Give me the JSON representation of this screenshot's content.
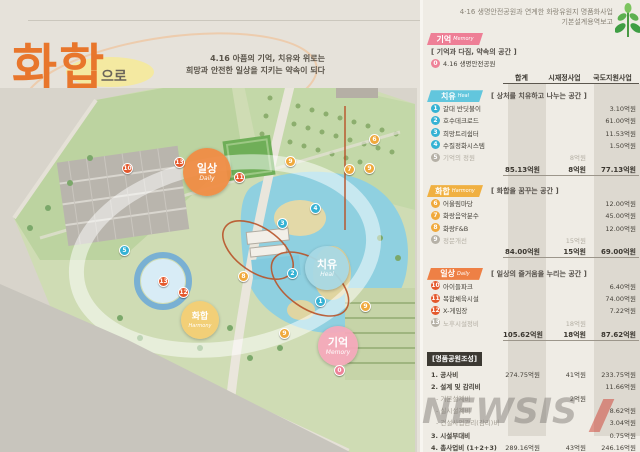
{
  "header": {
    "line1": "4·16 생명안전공원과 연계한 화랑유원지 명품화사업",
    "line2": "기본설계용역보고"
  },
  "title": {
    "word1": "화합",
    "particle": "으로",
    "word2": "순환",
    "suffix": "하다",
    "subtitle1": "4.16 아픔의 기억, 치유와 위로는",
    "subtitle2": "희망과 안전한 일상을 지키는 약속이 되다"
  },
  "map": {
    "zones": [
      {
        "name": "일상",
        "en": "Daily"
      },
      {
        "name": "치유",
        "en": "Heal"
      },
      {
        "name": "화합",
        "en": "Harmony"
      },
      {
        "name": "기억",
        "en": "Memory"
      }
    ],
    "markers": [
      {
        "n": "10",
        "x": 127,
        "y": 168,
        "k": "daily"
      },
      {
        "n": "13",
        "x": 179,
        "y": 162,
        "k": "daily"
      },
      {
        "n": "11",
        "x": 239,
        "y": 177,
        "k": "daily"
      },
      {
        "n": "9",
        "x": 290,
        "y": 161,
        "k": "harmony"
      },
      {
        "n": "6",
        "x": 374,
        "y": 139,
        "k": "harmony"
      },
      {
        "n": "7",
        "x": 349,
        "y": 169,
        "k": "harmony"
      },
      {
        "n": "9",
        "x": 369,
        "y": 168,
        "k": "harmony"
      },
      {
        "n": "4",
        "x": 315,
        "y": 208,
        "k": "heal"
      },
      {
        "n": "3",
        "x": 282,
        "y": 223,
        "k": "heal"
      },
      {
        "n": "5",
        "x": 124,
        "y": 250,
        "k": "heal"
      },
      {
        "n": "2",
        "x": 292,
        "y": 273,
        "k": "heal"
      },
      {
        "n": "1",
        "x": 320,
        "y": 301,
        "k": "heal"
      },
      {
        "n": "8",
        "x": 243,
        "y": 276,
        "k": "harmony"
      },
      {
        "n": "9",
        "x": 365,
        "y": 306,
        "k": "harmony"
      },
      {
        "n": "9",
        "x": 284,
        "y": 333,
        "k": "harmony"
      },
      {
        "n": "13",
        "x": 163,
        "y": 281,
        "k": "daily"
      },
      {
        "n": "12",
        "x": 183,
        "y": 292,
        "k": "daily"
      },
      {
        "n": "0",
        "x": 339,
        "y": 370,
        "k": "memory"
      }
    ]
  },
  "table": {
    "columns": [
      "합계",
      "시재정사업",
      "국도지원사업"
    ],
    "memory": {
      "label": "기억",
      "en": "Memory",
      "desc": "[ 기억과 다짐, 약속의 공간 ]",
      "rows": [
        {
          "num": "0",
          "k": "memory",
          "name": "4.16 생명안전공원",
          "values": [
            "",
            "",
            ""
          ]
        }
      ]
    },
    "sections": [
      {
        "key": "heal",
        "label": "치유",
        "en": "Heal",
        "desc": "[ 상처를 치유하고 나누는 공간 ]",
        "rows": [
          {
            "num": "1",
            "k": "heal",
            "name": "갈대 반딧불이",
            "values": [
              "",
              "",
              "3.10억원"
            ]
          },
          {
            "num": "2",
            "k": "heal",
            "name": "호수데크로드",
            "values": [
              "",
              "",
              "61.00억원"
            ]
          },
          {
            "num": "3",
            "k": "heal",
            "name": "희망트리쉼터",
            "values": [
              "",
              "",
              "11.53억원"
            ]
          },
          {
            "num": "4",
            "k": "heal",
            "name": "수질정화시스템",
            "values": [
              "",
              "",
              "1.50억원"
            ]
          },
          {
            "num": "5",
            "k": "gray",
            "name": "기억의 정원",
            "values": [
              "",
              "8억원",
              ""
            ],
            "cls": "gray"
          }
        ],
        "totals": [
          "85.13억원",
          "8억원",
          "77.13억원"
        ]
      },
      {
        "key": "harmony",
        "label": "화합",
        "en": "Harmony",
        "desc": "[ 화합을 꿈꾸는 공간 ]",
        "rows": [
          {
            "num": "6",
            "k": "harmony",
            "name": "어울림마당",
            "values": [
              "",
              "",
              "12.00억원"
            ]
          },
          {
            "num": "7",
            "k": "harmony",
            "name": "화랑음악분수",
            "values": [
              "",
              "",
              "45.00억원"
            ]
          },
          {
            "num": "8",
            "k": "harmony",
            "name": "화랑F&B",
            "values": [
              "",
              "",
              "12.00억원"
            ]
          },
          {
            "num": "9",
            "k": "gray",
            "name": "정문개선",
            "values": [
              "",
              "15억원",
              ""
            ],
            "cls": "gray"
          }
        ],
        "totals": [
          "84.00억원",
          "15억원",
          "69.00억원"
        ]
      },
      {
        "key": "daily",
        "label": "일상",
        "en": "Daily",
        "desc": "[ 일상의 즐거움을 누리는 공간 ]",
        "rows": [
          {
            "num": "10",
            "k": "daily",
            "name": "아이들파크",
            "values": [
              "",
              "",
              "6.40억원"
            ]
          },
          {
            "num": "11",
            "k": "daily",
            "name": "복합체육시설",
            "values": [
              "",
              "",
              "74.00억원"
            ]
          },
          {
            "num": "12",
            "k": "daily",
            "name": "X-게임장",
            "values": [
              "",
              "",
              "7.22억원"
            ]
          },
          {
            "num": "13",
            "k": "gray",
            "name": "노후시설정비",
            "values": [
              "",
              "18억원",
              ""
            ],
            "cls": "gray"
          }
        ],
        "totals": [
          "105.62억원",
          "18억원",
          "87.62억원"
        ]
      }
    ],
    "final": {
      "title": "[명품공원조성]",
      "rows": [
        {
          "name": "1. 공사비",
          "values": [
            "274.75억원",
            "41억원",
            "233.75억원"
          ],
          "cls": "strong"
        },
        {
          "name": "2. 설계 및 감리비",
          "values": [
            "",
            "",
            "11.66억원"
          ],
          "cls": "strong"
        },
        {
          "name": "- 기본설계비",
          "values": [
            "",
            "2억원",
            ""
          ],
          "cls": "sub"
        },
        {
          "name": "- 실시설계비",
          "values": [
            "",
            "",
            "8.62억원"
          ],
          "cls": "sub"
        },
        {
          "name": "- 건설사업관리(감리)비",
          "values": [
            "",
            "",
            "3.04억원"
          ],
          "cls": "sub"
        },
        {
          "name": "3. 시설부대비",
          "values": [
            "",
            "",
            "0.75억원"
          ],
          "cls": "strong"
        },
        {
          "name": "4. 총사업비 (1+2+3)",
          "values": [
            "289.16억원",
            "43억원",
            "246.16억원"
          ],
          "cls": "strong"
        }
      ]
    }
  },
  "watermark": {
    "text": "NEWSIS"
  },
  "colors": {
    "memory": "#ee7f96",
    "heal": "#62c6dd",
    "harmony": "#f0b041",
    "daily": "#ee8045",
    "title_orange": "#e8762c",
    "badge_dark": "#3c3933",
    "band_gray": "#bab4a8"
  }
}
